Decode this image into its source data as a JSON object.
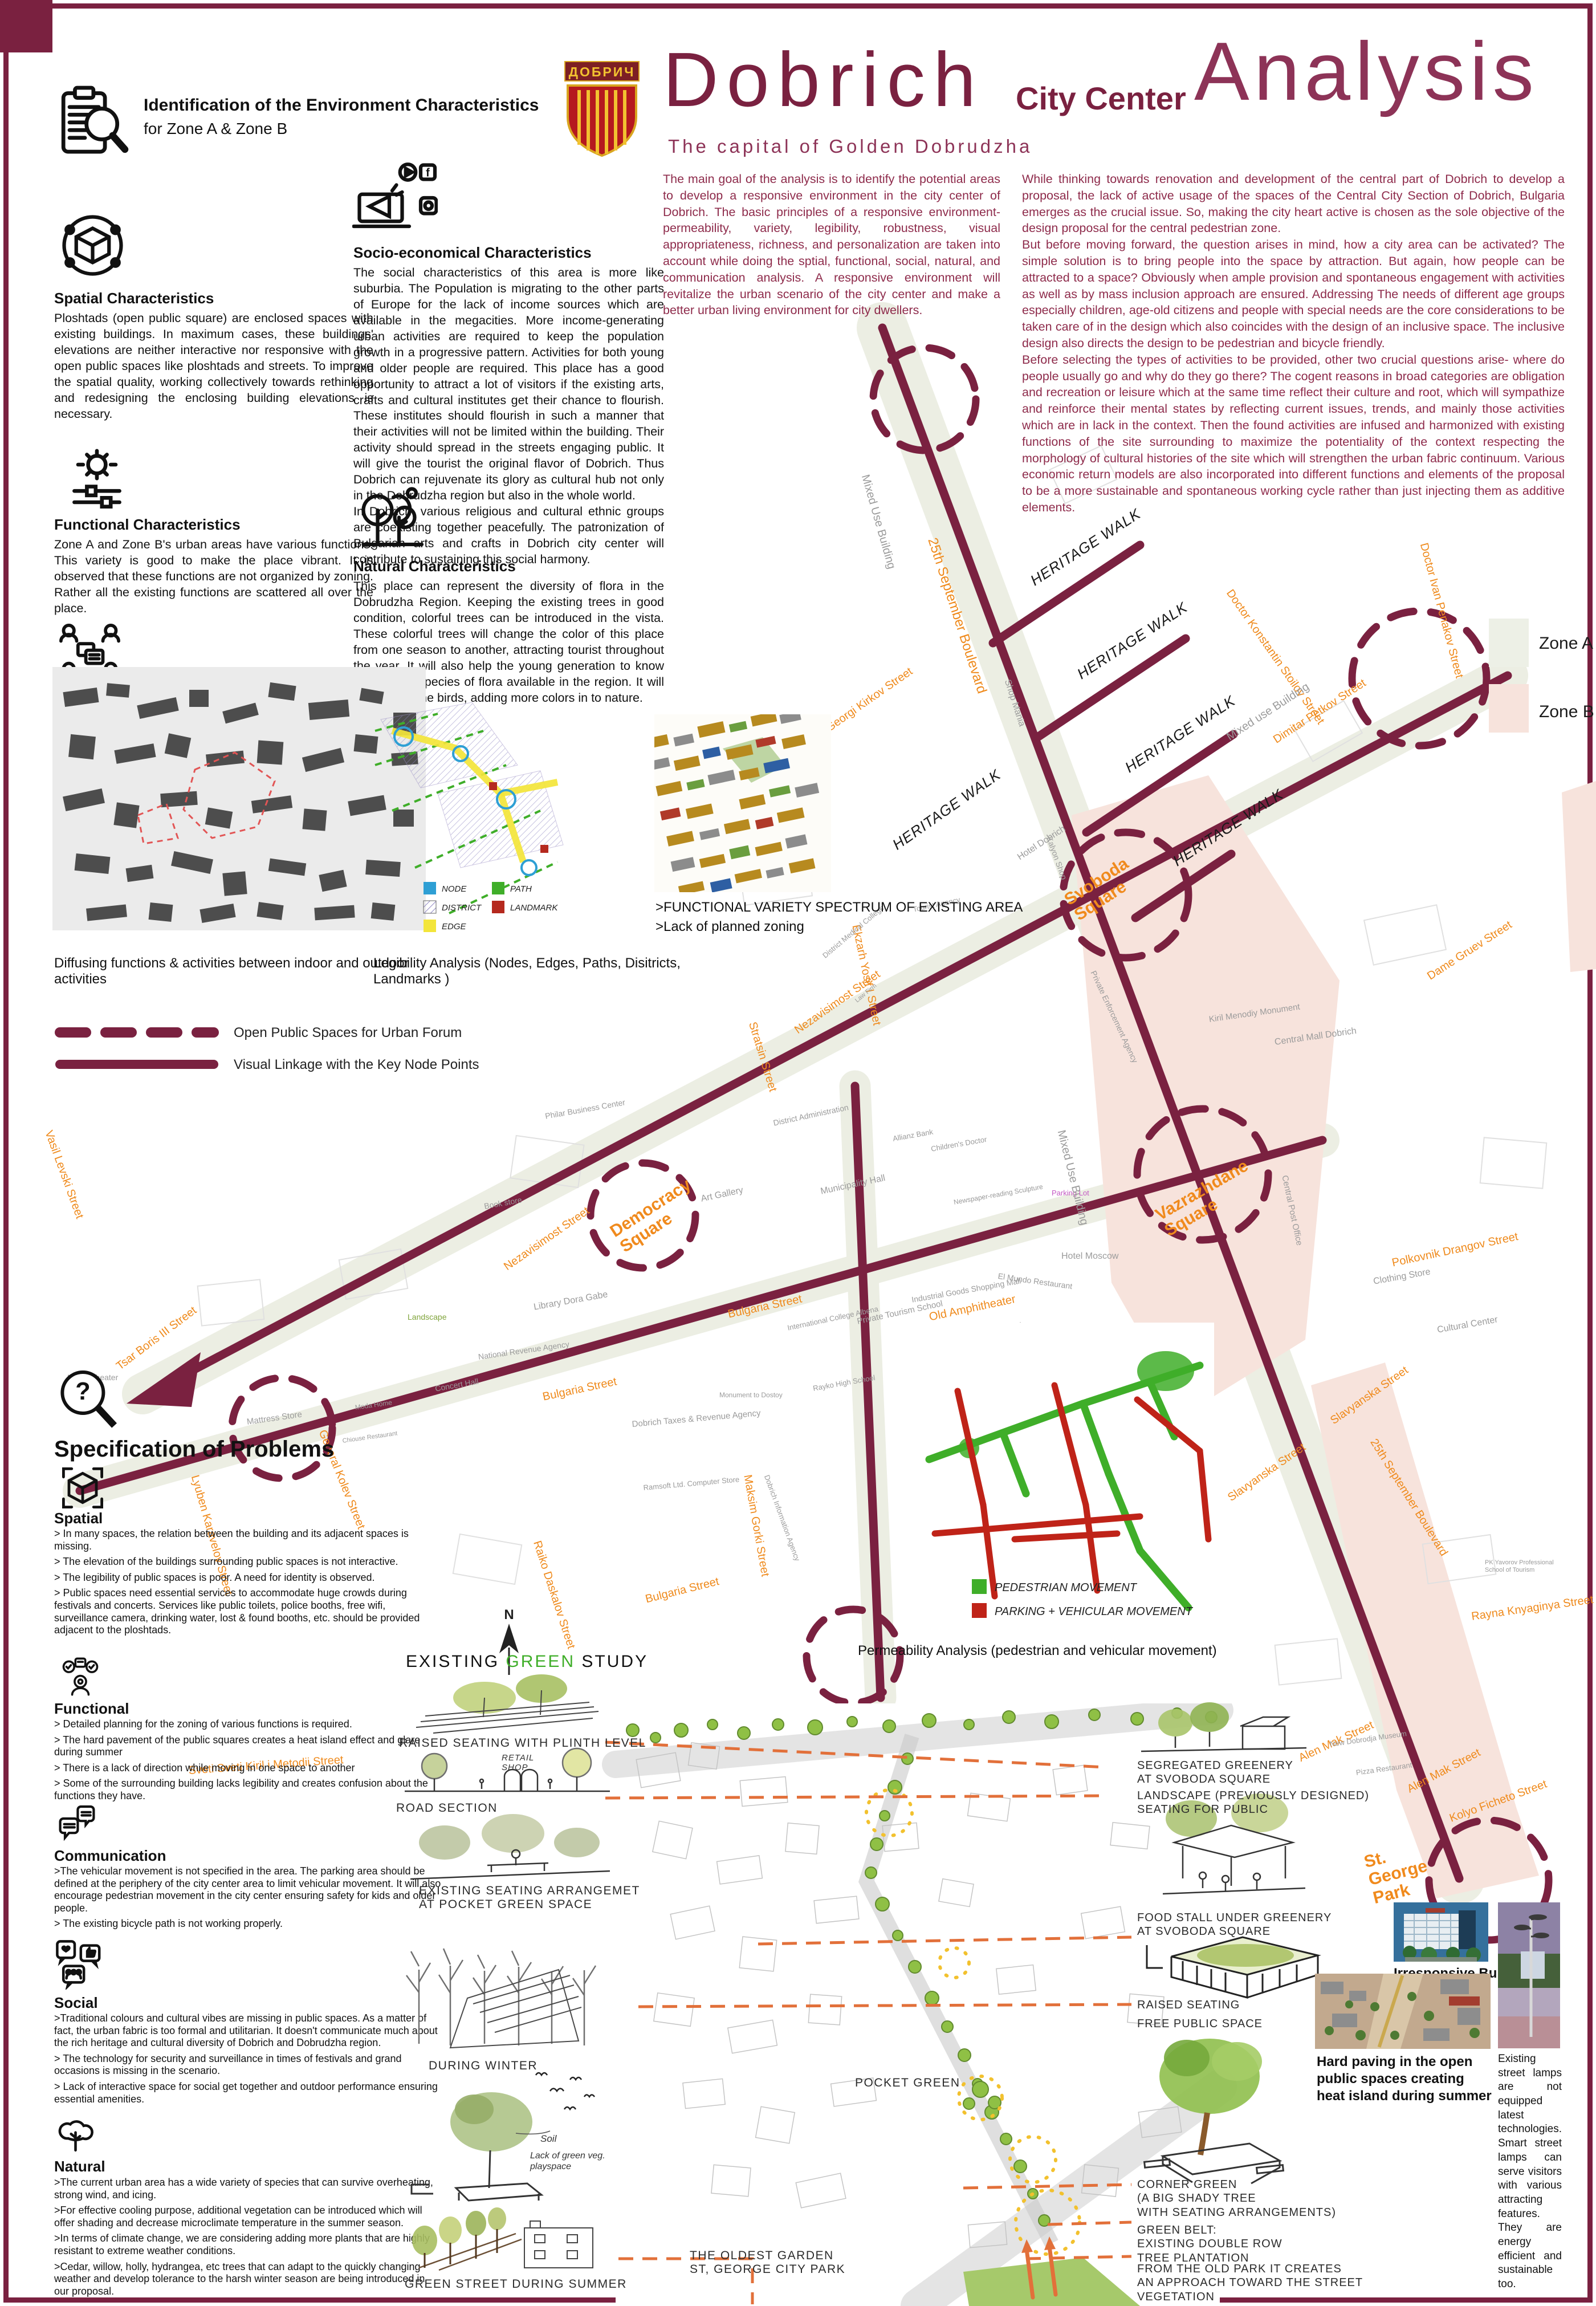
{
  "colors": {
    "maroon": "#7a2140",
    "maroon_light": "#8d3357",
    "orange_street": "#ef8a1c",
    "leader_orange": "#e2703a",
    "green": "#3fae29",
    "red": "#bf2318",
    "pink_zone": "#f7e3dc",
    "street_band": "#eceee3",
    "node_blue": "#2e9fd4",
    "edge_yellow": "#f3e53a",
    "landmark_red": "#b5291e"
  },
  "header": {
    "id_title": "Identification of the Environment Characteristics",
    "id_sub": "for  Zone A & Zone B",
    "title_main": "Dobrich",
    "title_mid": "City Center",
    "title_big": "Analysis",
    "subtitle": "The capital of Golden Dobrudzha",
    "intro_left": "The main goal of the analysis is to identify the potential areas to develop a responsive environment in the city center of Dobrich. The basic principles of a responsive environment- permeability, variety, legibility, robustness, visual appropriateness, richness, and personalization are taken into account while doing the sptial, functional, social, natural, and communication analysis. A responsive environment will revitalize the urban scenario of the city center and make a better urban living environment for city dwellers.",
    "intro_right": "While thinking towards renovation and development of the central part of Dobrich to develop a proposal, the lack of active usage of the spaces of the Central City Section of Dobrich, Bulgaria emerges as the crucial issue. So, making the city heart active is chosen as the sole objective of the design proposal for the central pedestrian zone.\nBut before moving forward, the question arises in mind, how a city area can be activated? The simple solution is to bring people into the space by attraction. But again, how people can be attracted to a space? Obviously when ample provision and spontaneous engagement with activities as well as by mass inclusion approach are ensured. Addressing The needs of different age groups especially children, age-old citizens and people with special needs are the core considerations to be taken care of in the design which also coincides with the design of an inclusive space. The inclusive design also directs the design to be pedestrian and bicycle friendly.\nBefore selecting the types of activities to be provided, other two crucial questions arise- where do people usually go and why do they go there? The cogent reasons in broad categories are obligation and recreation or leisure which at the same time reflect their culture and root, which will sympathize and reinforce their mental states by reflecting current issues, trends, and mainly those activities which are in lack in the context. Then the found activities are infused and harmonized with existing functions of the site surrounding to maximize the potentiality of the context respecting the morphology of cultural histories of the site which will strengthen the urban fabric continuum. Various economic return models are also incorporated into different functions and elements of the proposal to be a more sustainable and spontaneous working cycle rather than just injecting them as additive elements."
  },
  "logo": {
    "text": "ДОБРИЧ"
  },
  "characteristics": [
    {
      "title": "Spatial Characteristics",
      "body": "Ploshtads (open public square) are enclosed spaces with existing buildings. In maximum cases, these buildings' elevations are neither interactive nor responsive with the open public spaces like ploshtads and streets. To improve the spatial quality, working collectively towards rethinking and redesigning the enclosing building elevations is necessary."
    },
    {
      "title": "Functional Characteristics",
      "body": "Zone A and Zone B's urban areas have various functions. This variety is good to make the place vibrant. It is observed that these functions are not organized by zoning. Rather all the existing functions are scattered all over the place."
    },
    {
      "title": "Communication Characteristics",
      "body": "Because of the organic growth pattern of the existing boulevards and streets, both Zone A and Zone B have a good permeability. To ensure safe pedestrian movement, it is necessary to limit vehicular movement in the periphery."
    },
    {
      "title": "Socio-economical Characteristics",
      "body": "The social characteristics of this area is more like suburbia. The Population is migrating to the other parts of Europe for the lack of income sources which are available in the megacities. More income-generating urban activities are required to keep the population growth in a progressive pattern. Activities for both young and older people are required. This place has a good opportunity to attract a lot of visitors if the existing arts, crafts and cultural institutes get their chance to flourish. These institutes should flourish in such a manner that their activities will not be limited within the building. Their activity should spread in the streets engaging public. It will give the tourist the original flavor of Dobrich. Thus Dobrich can rejuvenate its glory as cultural hub not only in the Dobrudzha region but also in the whole world.\nIn Dobrich, various religious and cultural ethnic groups are coexisting together peacefully. The patronization of Bulgarian arts and crafts in Dobrich city center will contribute to sustaining this social harmony."
    },
    {
      "title": "Natural Characteristics",
      "body": "This place can represent the diversity of flora in the Dobrudzha Region. Keeping the existing trees in good condition, colorful trees can be introduced in the vista. These colorful trees will change the color of this place from one season to another, attracting tourist throughout the year. It will also help the young generation to know the various species of flora available in the region. It will also attract the birds, adding more colors in to nature."
    }
  ],
  "minimaps": {
    "figure_caption": "Diffusing functions & activities between indoor and outdoor activities",
    "legibility_caption": "Legibility Analysis (Nodes, Edges, Paths, Disitricts, Landmarks )",
    "legibility_legend": [
      "NODE",
      "DISTRICT",
      "EDGE",
      "PATH",
      "LANDMARK"
    ],
    "functional_line1": ">FUNCTIONAL VARIETY SPECTRUM OF EXISTING AREA",
    "functional_line2": ">Lack of planned zoning"
  },
  "legend": {
    "dashed": "Open Public Spaces for Urban Forum",
    "solid": "Visual Linkage with the Key Node Points"
  },
  "main_map": {
    "heritage_walk": "HERITAGE WALK",
    "squares": [
      "Svoboda\nSquare",
      "Vazrazhdane\nSquare",
      "Democracy\nSquare"
    ],
    "zones": [
      "Zone A",
      "Zone B"
    ],
    "park": "St.\nGeorge\nPark",
    "streets": [
      "25th September Boulevard",
      "25th September Boulevard",
      "General Kolev Street",
      "Doctor Konstantin Stoilov Street",
      "Doctor Ivan Penakov Street",
      "Dimitar Petkov Street",
      "Dame Gruev Street",
      "Polkovnik Drangov Street",
      "Bulgaria Street",
      "Bulgaria Street",
      "Bulgaria Street",
      "Nezavisimost Street",
      "Nezavisimost Street",
      "Maksim Gorki Street",
      "Raiko Daskalov Street",
      "Slavyanska Street",
      "Slavyanska Street",
      "Alen Mak Street",
      "Alen Mak Street",
      "Kolyo Ficheto Street",
      "Rayna Knyaginya Street",
      "Lyuben Karavelov Street",
      "Sveti Sveti Kiril i Metodii Street",
      "Tsar Boris III Street",
      "Vasil Levski Street",
      "Georgi Kirkov Street",
      "Ekzarh Yosif I Street",
      "Stratsin Street",
      "Old Amphitheater"
    ],
    "places": [
      "Shop Mania",
      "Kalyon Shop",
      "Private Enforcement Agency",
      "Hotel Dobrich",
      "Kiril Menodiy Monument",
      "Central Mall Dobrich",
      "Central Post Office",
      "Hotel Moscow",
      "El Mundo Restaurant",
      "Parking Lot",
      "Clothing Store",
      "Cultural Center",
      "Art Gallery",
      "Municipality Hall",
      "Allianz Bank",
      "Children's Doctor",
      "Library Dora Gabe",
      "Philar Business Center",
      "District Administration",
      "Dobrich Taxes & Revenue Agency",
      "Ramsoft Ltd. Computer Store",
      "Dobrich Information Agency",
      "Monument to Dostoy",
      "International College Albena",
      "Private Tourism School",
      "Rayko High School",
      "Newspaper-reading Sculpture",
      "Industrial Goods Shopping Mall",
      "Hotel Bulgaria",
      "Book store",
      "Concert Hall",
      "National Revenue Agency",
      "Landscape",
      "Moda Home",
      "Chiouse Restaurant",
      "Mattress Store",
      "Movie Theater",
      "New Dobrodja Museum",
      "Pizza Restaurant",
      "PK Yavorov Professional School of Tourism",
      "District Medical College",
      "Tourist Agency",
      "Law Firm",
      "Mixed Use Building",
      "Mixed use Building",
      "Mixed Use Building"
    ]
  },
  "permeability": {
    "caption": "Permeability Analysis (pedestrian and vehicular movement)",
    "legend_green": "PEDESTRIAN MOVEMENT",
    "legend_red": "PARKING + VEHICULAR MOVEMENT"
  },
  "problems": {
    "title": "Specification of Problems",
    "sections": [
      {
        "title": "Spatial",
        "items": [
          "> In many spaces, the relation between the building and its adjacent spaces is missing.",
          "> The elevation of the buildings surrounding public spaces is not interactive.",
          "> The legibility of public spaces is poor. A need for identity is observed.",
          "> Public spaces need essential services to accommodate huge crowds during festivals and concerts. Services like public toilets, police booths, free wifi, surveillance camera, drinking water, lost & found booths, etc. should be provided adjacent to the ploshtads."
        ]
      },
      {
        "title": "Functional",
        "items": [
          "> Detailed planning for the zoning of various functions is required.",
          "> The hard pavement of the public squares creates a heat island effect and glare during summer",
          "> There is a lack of direction while moving in one space to another",
          "> Some of the surrounding building lacks legibility and creates confusion about the functions they have."
        ]
      },
      {
        "title": "Communication",
        "items": [
          ">The vehicular movement is not specified in the area. The parking area should be defined at the periphery of the city center area to limit vehicular movement. It will also encourage pedestrian movement in the city center ensuring safety for kids and older people.",
          "> The existing bicycle path is not working properly."
        ]
      },
      {
        "title": "Social",
        "items": [
          ">Traditional colours and cultural vibes are missing in public spaces. As a matter of fact, the urban fabric is too formal and utilitarian. It doesn't communicate much about the rich heritage and cultural diversity of Dobrich and Dobrudzha region.",
          "> The technology for security and surveillance in times of festivals and grand occasions is missing in the scenario.",
          "> Lack of interactive space for social get together and outdoor performance ensuring essential amenities."
        ]
      },
      {
        "title": "Natural",
        "items": [
          ">The current urban area has a wide variety of species that can survive overheating, strong wind, and icing.",
          ">For effective cooling purpose, additional vegetation can be introduced which will offer shading and decrease microclimate temperature in the summer season.",
          ">In terms of climate change, we are considering adding more plants that are highly resistant to extreme weather conditions.",
          ">Cedar, willow, holly, hydrangea, etc trees that can adapt to the quickly changing weather and develop tolerance to the harsh winter season are being introduced in our proposal."
        ]
      }
    ]
  },
  "green_study": {
    "t1": "EXISTING",
    "t2": "GREEN",
    "t3": "STUDY",
    "cap1": "RAISED SEATING WITH PLINTH LEVEL",
    "cap2": "ROAD SECTION",
    "cap3": "EXISTING SEATING ARRANGEMET\nAT POCKET GREEN SPACE",
    "cap4": "DURING WINTER",
    "cap5": "GREEN STREET DURING SUMMER",
    "retail": "RETAIL\nSHOP",
    "soil": "Soil",
    "lack": "Lack of green veg.\nplayspace"
  },
  "bottom_map": {
    "pocket": "POCKET GREEN",
    "oldest": "THE OLDEST GARDEN\nST, GEORGE CITY PARK"
  },
  "callouts": [
    "SEGREGATED GREENERY\nAT SVOBODA SQUARE",
    "LANDSCAPE (PREVIOUSLY DESIGNED)\nSEATING FOR PUBLIC",
    "FOOD STALL UNDER GREENERY\nAT SVOBODA SQUARE",
    "RAISED SEATING",
    "FREE PUBLIC SPACE",
    "CORNER GREEN\n(A BIG SHADY TREE\nWITH SEATING ARRANGEMENTS)",
    "GREEN BELT:\nEXISTING DOUBLE ROW\nTREE PLANTATION",
    "FROM THE OLD PARK IT CREATES\nAN APPROACH TOWARD THE STREET\nVEGETATION"
  ],
  "photos": {
    "building": "Irresponsive Building Facade",
    "paving": "Hard paving in the open public spaces creating heat island during summer",
    "lamps": "Existing street lamps are not equipped latest technologies. Smart street lamps can serve visitors with various attracting features. They are energy efficient and sustainable too."
  },
  "compass": "N"
}
